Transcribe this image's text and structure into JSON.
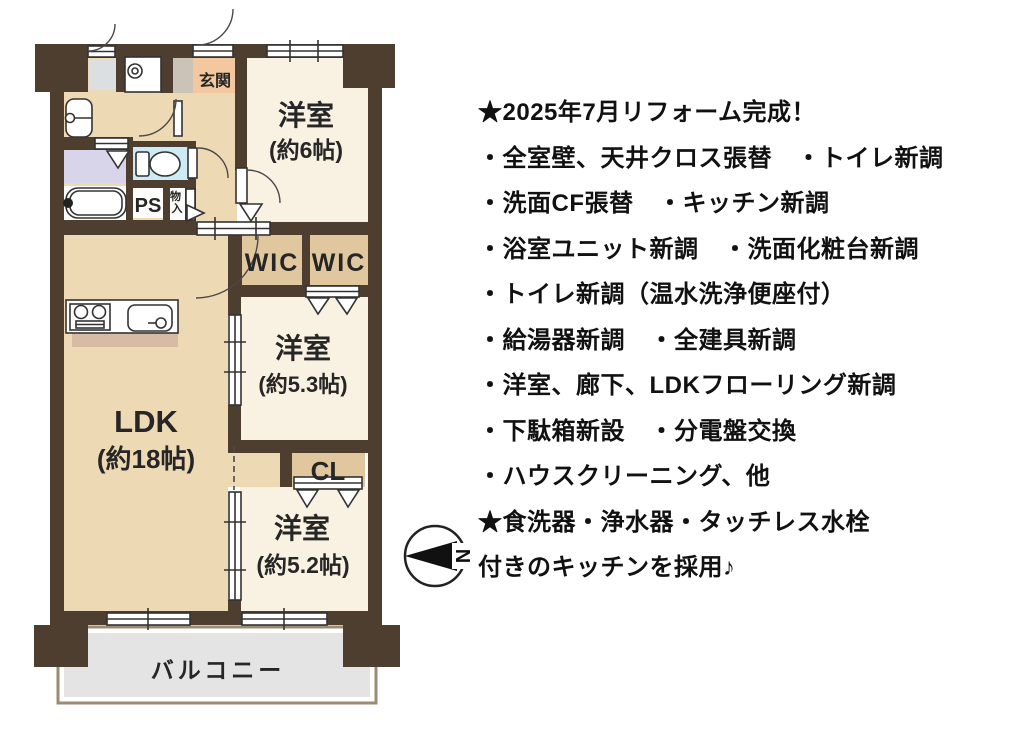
{
  "floor_plan": {
    "rooms": [
      {
        "id": "bedroom-6",
        "label": "洋室",
        "size": "(約6帖)"
      },
      {
        "id": "bedroom-53",
        "label": "洋室",
        "size": "(約5.3帖)"
      },
      {
        "id": "bedroom-52",
        "label": "洋室",
        "size": "(約5.2帖)"
      },
      {
        "id": "ldk",
        "label": "LDK",
        "size": "(約18帖)"
      }
    ],
    "labels": {
      "genkan": "玄関",
      "wic1": "WIC",
      "wic2": "WIC",
      "cl": "CL",
      "ps": "PS",
      "storage_chars": [
        "物",
        "入"
      ],
      "balcony": "バルコニー",
      "compass_n": "N"
    },
    "colors": {
      "wall": "#4e3e30",
      "hall_floor": "#edd9b4",
      "room_floor": "#f9f2e3",
      "wic_floor": "#e1c79e",
      "genkan_floor": "#f4c89e",
      "genkan_gray": "#cbc2b8",
      "alcove_gray": "#dcdfe2",
      "toilet_floor": "#cdeaf5",
      "washroom_floor": "#d8d5eb",
      "white_floor": "#fcfcfa",
      "balcony_gray": "#e4e4e4",
      "balcony_border": "#9b8b73",
      "counter_shade": "#d8bba3"
    }
  },
  "notes": {
    "lines": [
      "★2025年7月リフォーム完成！",
      "・全室壁、天井クロス張替　・トイレ新調",
      "・洗面CF張替　・キッチン新調",
      "・浴室ユニット新調　・洗面化粧台新調",
      "・トイレ新調（温水洗浄便座付）",
      "・給湯器新調　・全建具新調",
      "・洋室、廊下、LDKフローリング新調",
      "・下駄箱新設　・分電盤交換",
      "・ハウスクリーニング、他",
      "★食洗器・浄水器・タッチレス水栓",
      "付きのキッチンを採用♪"
    ]
  }
}
